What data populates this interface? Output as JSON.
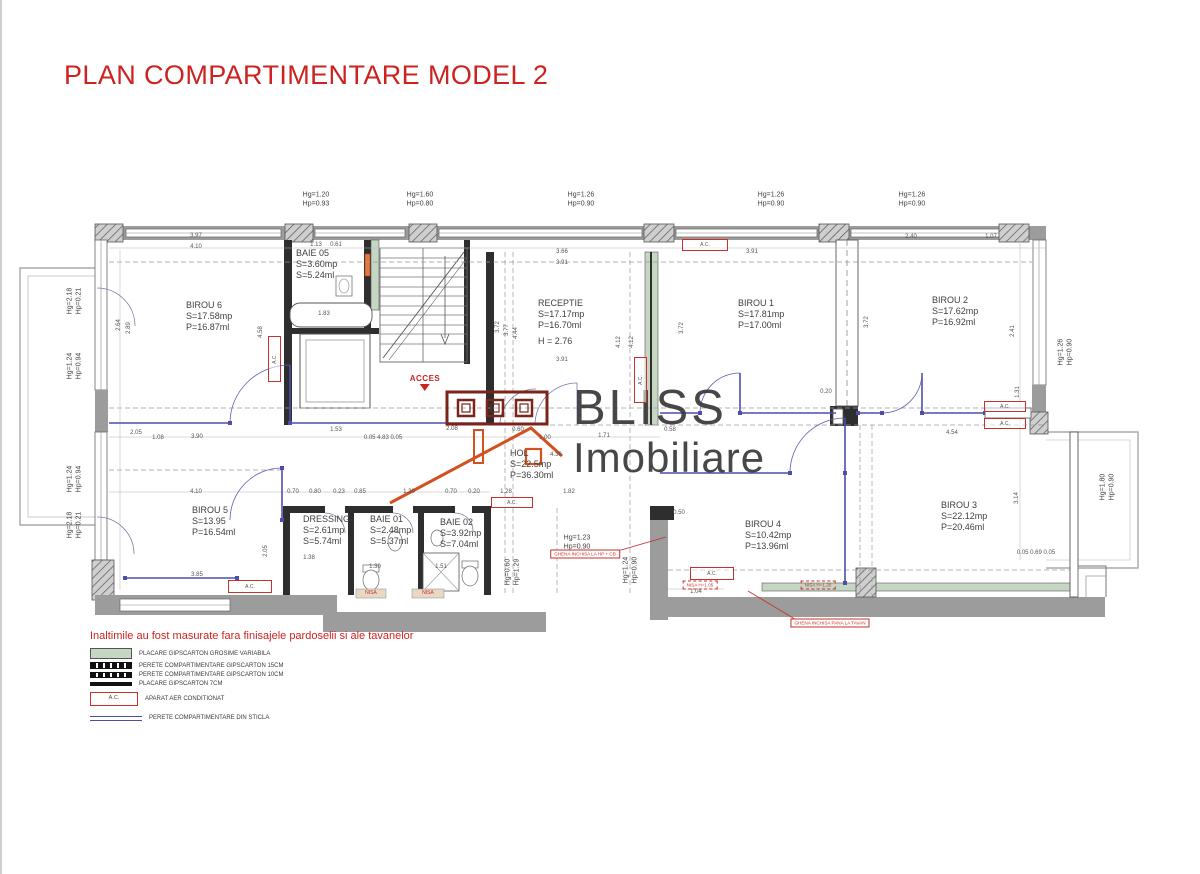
{
  "title": "PLAN COMPARTIMENTARE MODEL 2",
  "note": "Inaltimile au fost masurate fara finisajele pardoselii si ale tavanelor",
  "acces_label": "ACCES",
  "ac_text": "A.C.",
  "watermark": {
    "line1": "BLISS",
    "line2": "Imobiliare"
  },
  "colors": {
    "accent_red": "#c8302e",
    "wall_gray": "#9c9c9c",
    "glass_blue": "#4d4dae",
    "placare_green": "#c5d6c3",
    "logo_orange": "#d2511e",
    "logo_maroon": "#7a241c"
  },
  "rooms": [
    {
      "name": "BIROU 6",
      "lines": [
        "S=17.58mp",
        "P=16.87ml"
      ],
      "x": 186,
      "y": 300
    },
    {
      "name": "BAIE 05",
      "lines": [
        "S=3.60mp",
        "S=5.24ml"
      ],
      "x": 296,
      "y": 248
    },
    {
      "name": "RECEPTIE",
      "lines": [
        "S=17.17mp",
        "P=16.70ml",
        "H = 2.76"
      ],
      "x": 538,
      "y": 298
    },
    {
      "name": "BIROU 1",
      "lines": [
        "S=17.81mp",
        "P=17.00ml"
      ],
      "x": 738,
      "y": 298
    },
    {
      "name": "BIROU 2",
      "lines": [
        "S=17.62mp",
        "P=16.92ml"
      ],
      "x": 932,
      "y": 295
    },
    {
      "name": "BIROU 5",
      "lines": [
        "S=13.95",
        "P=16.54ml"
      ],
      "x": 192,
      "y": 505
    },
    {
      "name": "DRESSING",
      "lines": [
        "S=2.61mp",
        "S=5.74ml"
      ],
      "x": 303,
      "y": 514
    },
    {
      "name": "BAIE 01",
      "lines": [
        "S=2.48mp",
        "S=5.37ml"
      ],
      "x": 370,
      "y": 514
    },
    {
      "name": "BAIE 02",
      "lines": [
        "S=3.92mp",
        "S=7.04ml"
      ],
      "x": 440,
      "y": 517
    },
    {
      "name": "HOL",
      "lines": [
        "S=22.5mp",
        "P=36.30ml"
      ],
      "x": 510,
      "y": 448
    },
    {
      "name": "BIROU 4",
      "lines": [
        "S=10.42mp",
        "P=13.96ml"
      ],
      "x": 745,
      "y": 519
    },
    {
      "name": "BIROU 3",
      "lines": [
        "S=22.12mp",
        "P=20.46ml"
      ],
      "x": 941,
      "y": 500
    }
  ],
  "hg_hp_labels": [
    {
      "hg": "Hg=1.20",
      "hp": "Hp=0.93",
      "x": 316,
      "y": 200
    },
    {
      "hg": "Hg=1.60",
      "hp": "Hp=0.80",
      "x": 420,
      "y": 200
    },
    {
      "hg": "Hg=1.26",
      "hp": "Hp=0.90",
      "x": 581,
      "y": 200
    },
    {
      "hg": "Hg=1.26",
      "hp": "Hp=0.90",
      "x": 771,
      "y": 200
    },
    {
      "hg": "Hg=1.26",
      "hp": "Hp=0.90",
      "x": 912,
      "y": 200
    },
    {
      "hg": "Hg=2.18",
      "hp": "Hp=0.21",
      "x": 75,
      "y": 301,
      "r": 1
    },
    {
      "hg": "Hg=1.24",
      "hp": "Hp=0.94",
      "x": 75,
      "y": 366,
      "r": 1
    },
    {
      "hg": "Hg=1.24",
      "hp": "Hp=0.94",
      "x": 75,
      "y": 479,
      "r": 1
    },
    {
      "hg": "Hg=2.18",
      "hp": "Hp=0.21",
      "x": 75,
      "y": 525,
      "r": 1
    },
    {
      "hg": "Hg=1.26",
      "hp": "Hp=0.90",
      "x": 1066,
      "y": 352,
      "r": 1
    },
    {
      "hg": "Hg=1.80",
      "hp": "Hp=0.90",
      "x": 1108,
      "y": 487,
      "r": 1
    },
    {
      "hg": "Hg=1.23",
      "hp": "Hp=0.90",
      "x": 577,
      "y": 543
    },
    {
      "hg": "Hg=0.60",
      "hp": "Hp=1.29",
      "x": 513,
      "y": 572,
      "r": 1
    },
    {
      "hg": "Hg=1.24",
      "hp": "Hp=0.90",
      "x": 631,
      "y": 570,
      "r": 1
    }
  ],
  "dimensions": [
    {
      "t": "3.97",
      "x": 196,
      "y": 236
    },
    {
      "t": "4.10",
      "x": 196,
      "y": 247
    },
    {
      "t": "1.13",
      "x": 316,
      "y": 245
    },
    {
      "t": "0.61",
      "x": 336,
      "y": 245
    },
    {
      "t": "3.66",
      "x": 562,
      "y": 252
    },
    {
      "t": "3.91",
      "x": 562,
      "y": 263
    },
    {
      "t": "3.91",
      "x": 752,
      "y": 252
    },
    {
      "t": "2.40",
      "x": 911,
      "y": 237
    },
    {
      "t": "1.07",
      "x": 991,
      "y": 237
    },
    {
      "t": "1.83",
      "x": 324,
      "y": 314
    },
    {
      "t": "3.91",
      "x": 562,
      "y": 360
    },
    {
      "t": "2.64",
      "x": 119,
      "y": 325,
      "r": 1
    },
    {
      "t": "2.89",
      "x": 129,
      "y": 328,
      "r": 1
    },
    {
      "t": "4.58",
      "x": 261,
      "y": 332,
      "r": 1
    },
    {
      "t": "3.72",
      "x": 498,
      "y": 327,
      "r": 1
    },
    {
      "t": "3.77",
      "x": 507,
      "y": 330,
      "r": 1
    },
    {
      "t": "4.44",
      "x": 516,
      "y": 333,
      "r": 1
    },
    {
      "t": "4.12",
      "x": 619,
      "y": 342,
      "r": 1
    },
    {
      "t": "4.12",
      "x": 632,
      "y": 342,
      "r": 1
    },
    {
      "t": "3.72",
      "x": 682,
      "y": 328,
      "r": 1
    },
    {
      "t": "3.72",
      "x": 867,
      "y": 322,
      "r": 1
    },
    {
      "t": "2.41",
      "x": 1013,
      "y": 331,
      "r": 1
    },
    {
      "t": "1.31",
      "x": 1018,
      "y": 392,
      "r": 1
    },
    {
      "t": "3.14",
      "x": 1017,
      "y": 498,
      "r": 1
    },
    {
      "t": "2.05",
      "x": 136,
      "y": 433
    },
    {
      "t": "1.08",
      "x": 158,
      "y": 438
    },
    {
      "t": "3.90",
      "x": 197,
      "y": 437
    },
    {
      "t": "1.53",
      "x": 336,
      "y": 430
    },
    {
      "t": "0.05 4.83 0.05",
      "x": 383,
      "y": 438
    },
    {
      "t": "2.08",
      "x": 452,
      "y": 429
    },
    {
      "t": "0.60",
      "x": 518,
      "y": 430
    },
    {
      "t": "1.00",
      "x": 545,
      "y": 438
    },
    {
      "t": "4.36",
      "x": 556,
      "y": 455
    },
    {
      "t": "1.71",
      "x": 604,
      "y": 436
    },
    {
      "t": "0.58",
      "x": 670,
      "y": 430
    },
    {
      "t": "0.20",
      "x": 826,
      "y": 392
    },
    {
      "t": "4.54",
      "x": 952,
      "y": 433
    },
    {
      "t": "4.10",
      "x": 196,
      "y": 492
    },
    {
      "t": "0.70",
      "x": 293,
      "y": 492
    },
    {
      "t": "0.80",
      "x": 315,
      "y": 492
    },
    {
      "t": "0.23",
      "x": 339,
      "y": 492
    },
    {
      "t": "0.85",
      "x": 360,
      "y": 492
    },
    {
      "t": "1.30",
      "x": 409,
      "y": 492
    },
    {
      "t": "0.70",
      "x": 451,
      "y": 492
    },
    {
      "t": "0.20",
      "x": 474,
      "y": 492
    },
    {
      "t": "3.85",
      "x": 197,
      "y": 575
    },
    {
      "t": "1.38",
      "x": 309,
      "y": 558
    },
    {
      "t": "1.30",
      "x": 375,
      "y": 567
    },
    {
      "t": "1.51",
      "x": 441,
      "y": 567
    },
    {
      "t": "2.05",
      "x": 266,
      "y": 551,
      "r": 1
    },
    {
      "t": "0.50",
      "x": 679,
      "y": 513
    },
    {
      "t": "1.04",
      "x": 696,
      "y": 592
    },
    {
      "t": "1.28",
      "x": 506,
      "y": 492
    },
    {
      "t": "1.82",
      "x": 569,
      "y": 492
    },
    {
      "t": "0.05 0.69 0.05",
      "x": 1036,
      "y": 553
    }
  ],
  "ac_units": [
    {
      "x": 682,
      "y": 239,
      "w": 46,
      "h": 12
    },
    {
      "x": 634,
      "y": 357,
      "w": 13,
      "h": 46,
      "r": 1
    },
    {
      "x": 268,
      "y": 336,
      "w": 13,
      "h": 46,
      "r": 1
    },
    {
      "x": 228,
      "y": 580,
      "w": 44,
      "h": 13
    },
    {
      "x": 491,
      "y": 497,
      "w": 42,
      "h": 11
    },
    {
      "x": 690,
      "y": 567,
      "w": 44,
      "h": 13
    },
    {
      "x": 984,
      "y": 401,
      "w": 42,
      "h": 11
    },
    {
      "x": 984,
      "y": 418,
      "w": 42,
      "h": 11
    }
  ],
  "red_notes": [
    {
      "t": "GHENA INCHISA LA HP + CB",
      "x": 585,
      "y": 554
    },
    {
      "t": "GHENA INCHISA PANA LA TAVAN",
      "x": 830,
      "y": 623
    },
    {
      "t": "NISA H=1.05",
      "x": 700,
      "y": 585,
      "style": "dashed"
    },
    {
      "t": "NISA H=1.20",
      "x": 818,
      "y": 585,
      "style": "dashed"
    },
    {
      "t": "NISA",
      "x": 371,
      "y": 593,
      "style": "plain"
    },
    {
      "t": "NISA",
      "x": 428,
      "y": 593,
      "style": "plain"
    }
  ],
  "legend": {
    "rows": [
      {
        "sw": "green",
        "label": "PLACARE GIPSCARTON GROSIME VARIABILA"
      },
      {
        "sw": "w15",
        "label": "PERETE COMPARTIMENTARE GIPSCARTON 15CM"
      },
      {
        "sw": "w10",
        "label": "PERETE COMPARTIMENTARE GIPSCARTON 10CM"
      },
      {
        "sw": "w7",
        "label": "PLACARE GIPSCARTON 7CM"
      },
      {
        "sw": "ac",
        "label": "APARAT AER CONDITIONAT"
      },
      {
        "sw": "glass",
        "label": "PERETE COMPARTIMENTARE DIN STICLA"
      }
    ]
  }
}
